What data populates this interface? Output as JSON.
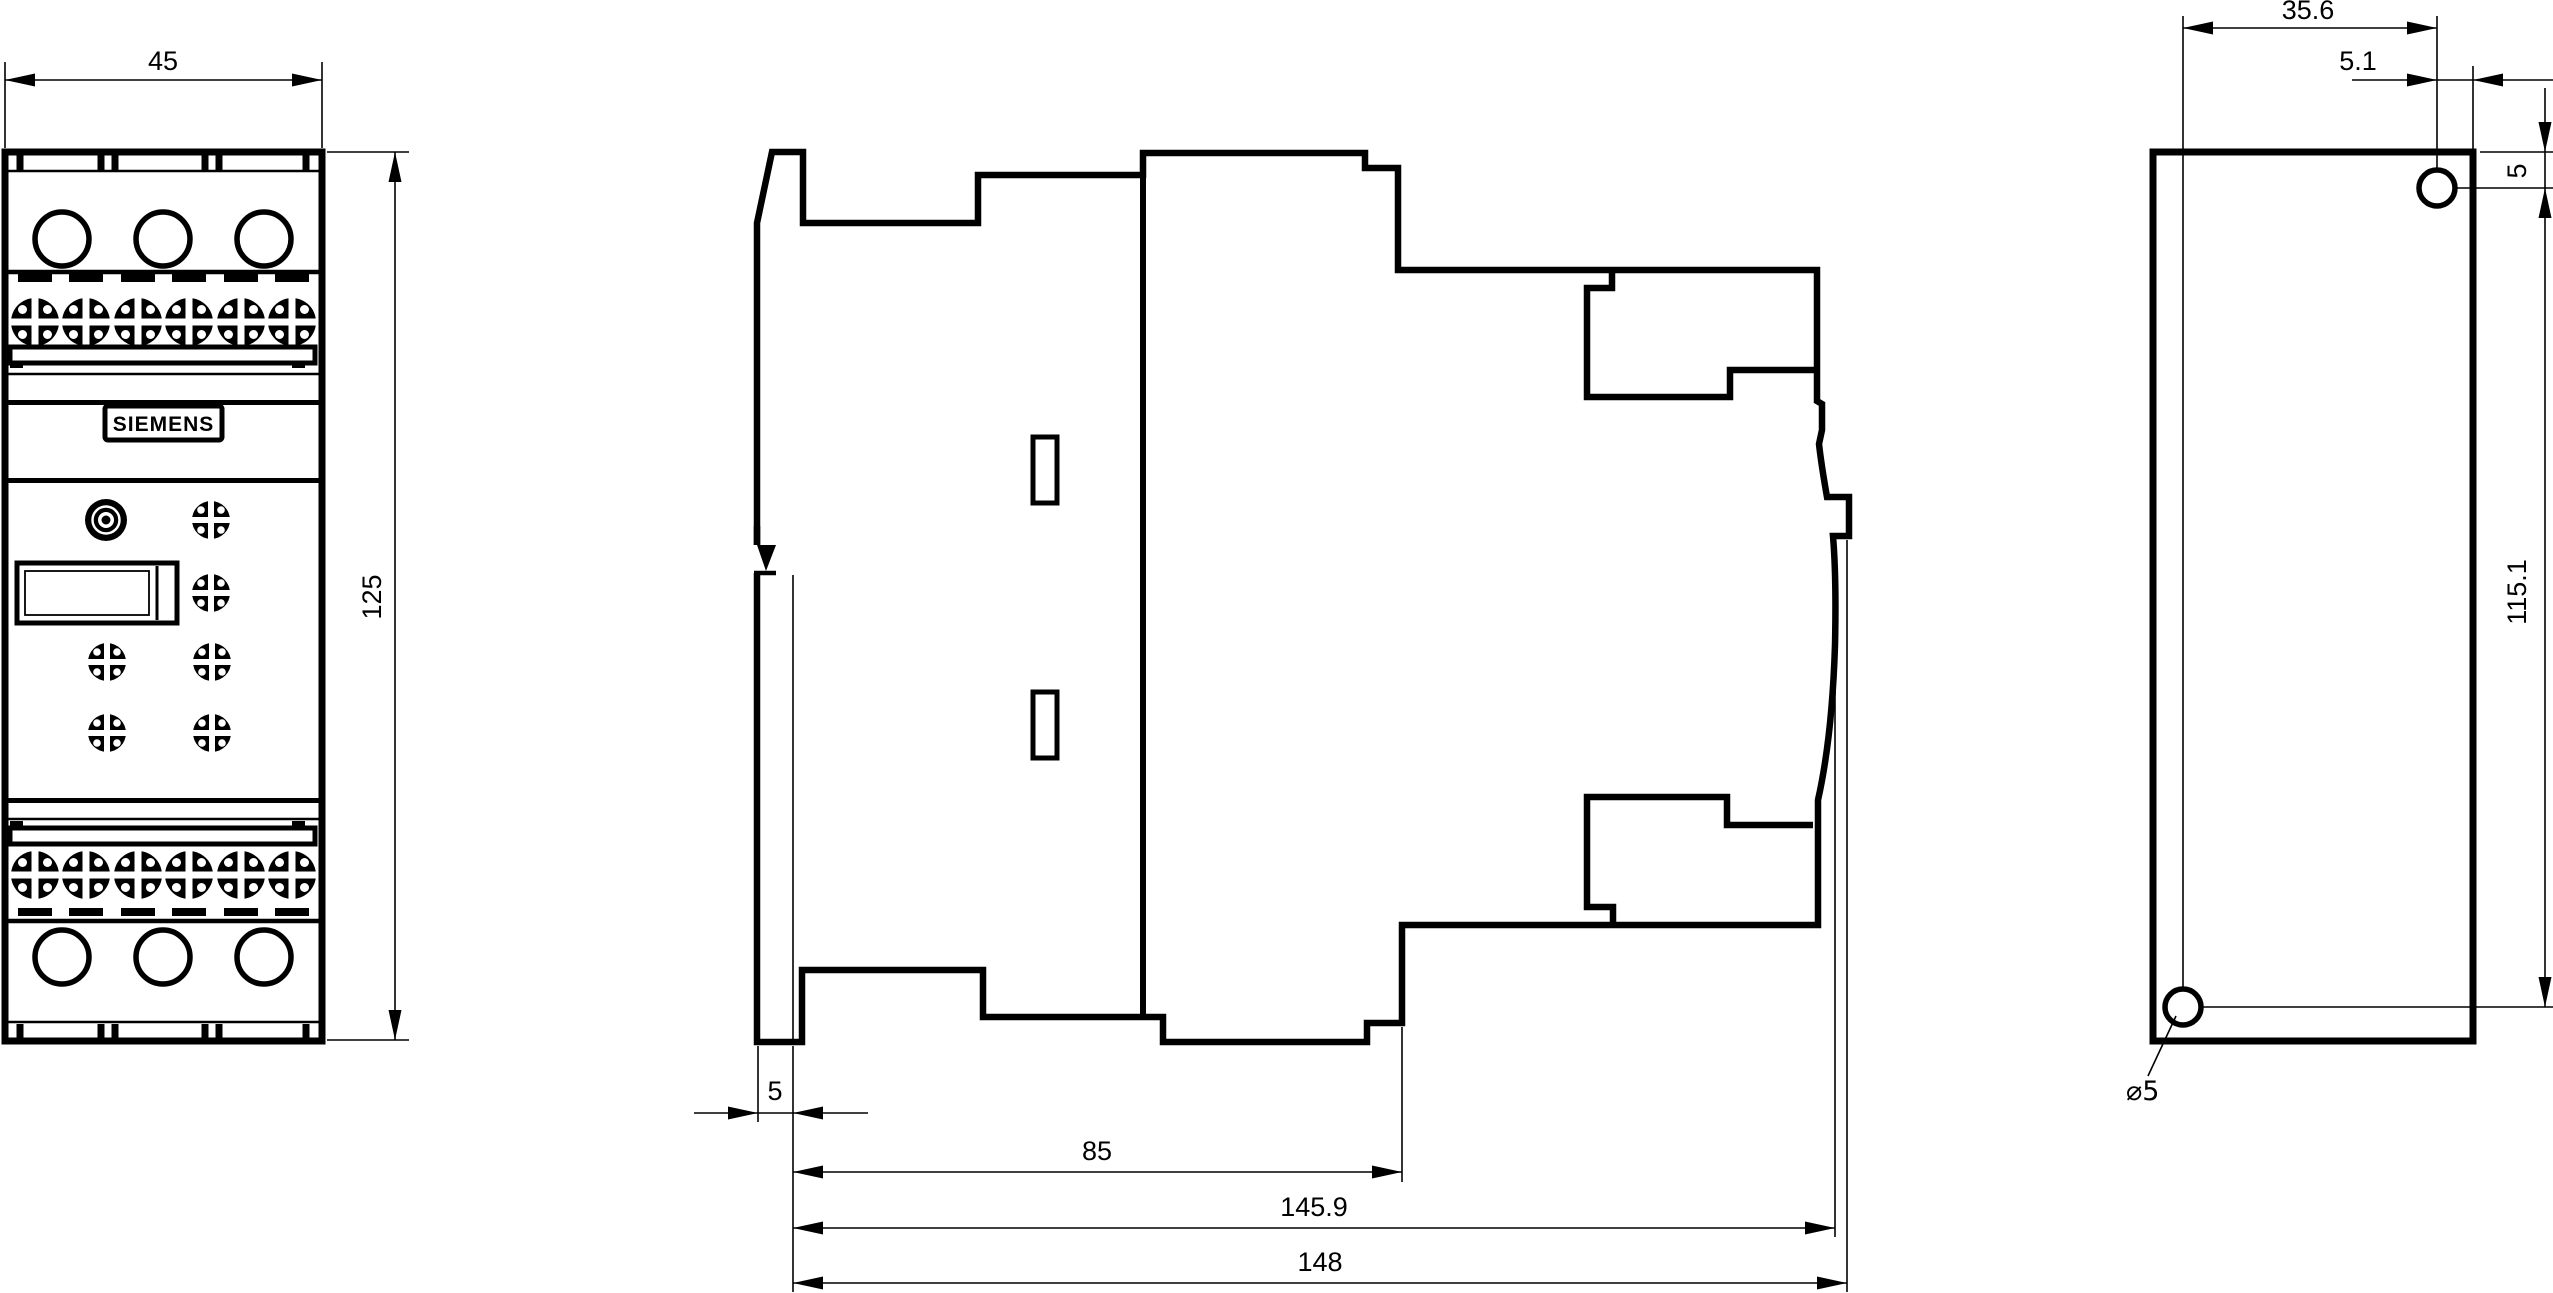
{
  "views": {
    "front": {
      "width_dim": "45",
      "height_dim": "125",
      "brand": "SIEMENS"
    },
    "side": {
      "rail_plate_dim": "5",
      "body_depth_dim": "85",
      "depth_without_latch_dim": "145.9",
      "total_depth_dim": "148"
    },
    "rear": {
      "hole_offset_dim": "35.6",
      "hole_to_edge_dim": "5.1",
      "hole_to_top_dim": "5",
      "hole_pitch_dim": "115.1",
      "hole_diameter_dim": "⌀5"
    }
  }
}
